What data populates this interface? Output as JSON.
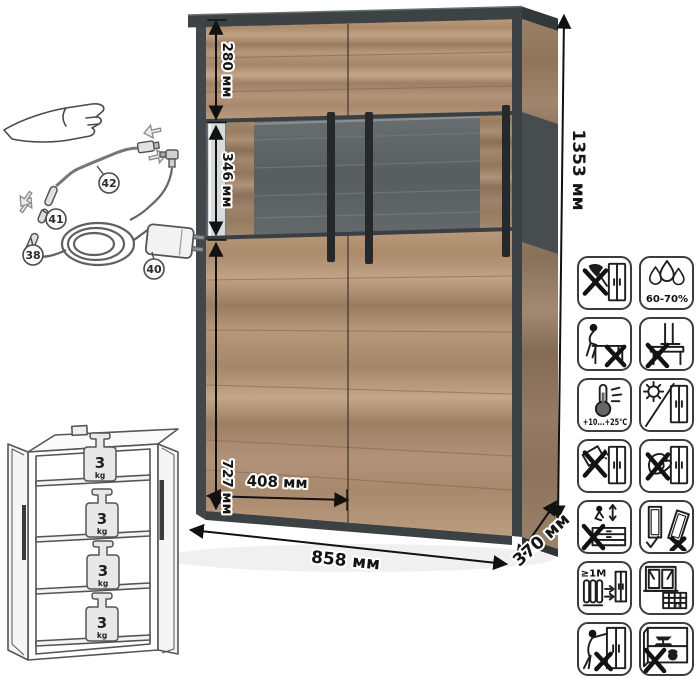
{
  "product": {
    "dimensions": {
      "upper_section_height": "280 мм",
      "display_section_height": "346 мм",
      "lower_section_height": "727 мм",
      "door_width": "408 мм",
      "total_width": "858 мм",
      "depth": "370 мм",
      "total_height": "1353 мм"
    },
    "lighting_kit_parts": {
      "led_strip": "38",
      "power_adapter": "40",
      "connector": "41",
      "cable": "42"
    },
    "shelf_load": {
      "value": "3",
      "unit": "kg"
    },
    "care_labels": {
      "humidity_range": "60-70%",
      "temperature_range": "+10...+25°C",
      "heater_distance": "≥1M",
      "vent_tile_number": "25"
    },
    "colors": {
      "wood": "#b2937a",
      "wood_dark": "#8d7159",
      "frame_dark": "#41464a",
      "handle": "#26292c",
      "glass_back": "#5d6263",
      "dimension_text": "#141414"
    }
  }
}
